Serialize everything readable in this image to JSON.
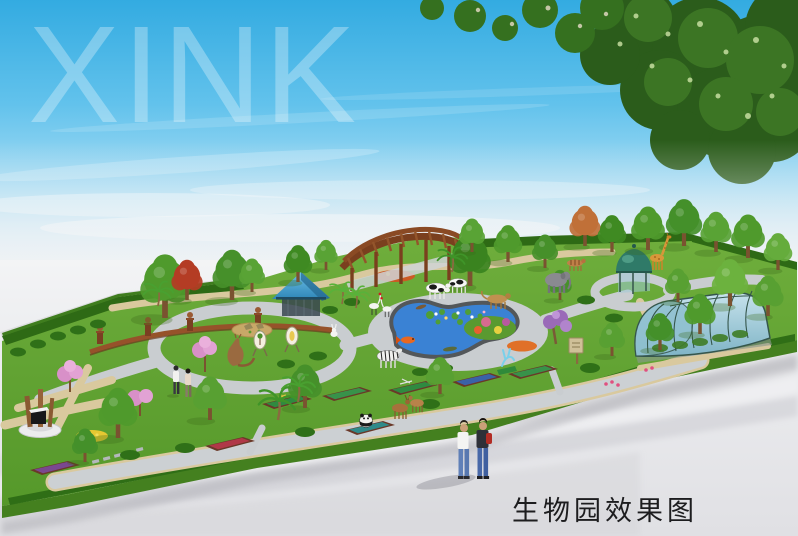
{
  "image": {
    "kind": "landscape-architecture-rendering",
    "subject": "biology-garden-park-aerial-perspective"
  },
  "watermark": {
    "text": "XINK",
    "color": "#ffffff",
    "opacity": "0.3"
  },
  "caption": {
    "text": "生物园效果图",
    "color": "#1d1d1f"
  },
  "palette": {
    "sky_top": "#33abe1",
    "sky_horizon": "#e8f5fb",
    "mist": "#ededef",
    "ground": "#e2e2e5",
    "grass": "#61a331",
    "grass_dark": "#44801f",
    "hedge": "#2e6a15",
    "canopy": "#2b5c1b",
    "path_gray": "#c9cdd1",
    "path_tan": "#d9c99e",
    "water": "#3a82d4",
    "pond_rim": "#53575a",
    "pergola_wood": "#8a4a24",
    "pavilion_roof": "#3a8fc0",
    "dome_kiosk": "#2f7a68",
    "greenhouse_glass": "#9fc8d6",
    "flower_pink": "#d890c8",
    "flower_orange": "#cc5a24",
    "flower_yellow": "#e6c832"
  },
  "scene": {
    "features": [
      "sky",
      "cloud-bank",
      "xink-watermark",
      "overhanging-tree-canopy",
      "garden-platform",
      "perimeter-hedge",
      "curved-pergola",
      "blue-pavilion",
      "dome-kiosk",
      "greenhouse-tunnel",
      "kidney-pond",
      "bust-plaza",
      "monument-sculpture",
      "display-beds",
      "stepping-stones",
      "flower-beds",
      "palm-trees",
      "animal-statues",
      "visitors",
      "caption-text"
    ],
    "animal_statues": [
      "cows",
      "lioness",
      "elephant",
      "giraffe",
      "zebra",
      "red-crowned-cranes",
      "rabbit",
      "kangaroo",
      "panda",
      "deer",
      "crocodiles",
      "koi-fish",
      "blue-antelope-sculpture"
    ],
    "people_count": 4
  }
}
